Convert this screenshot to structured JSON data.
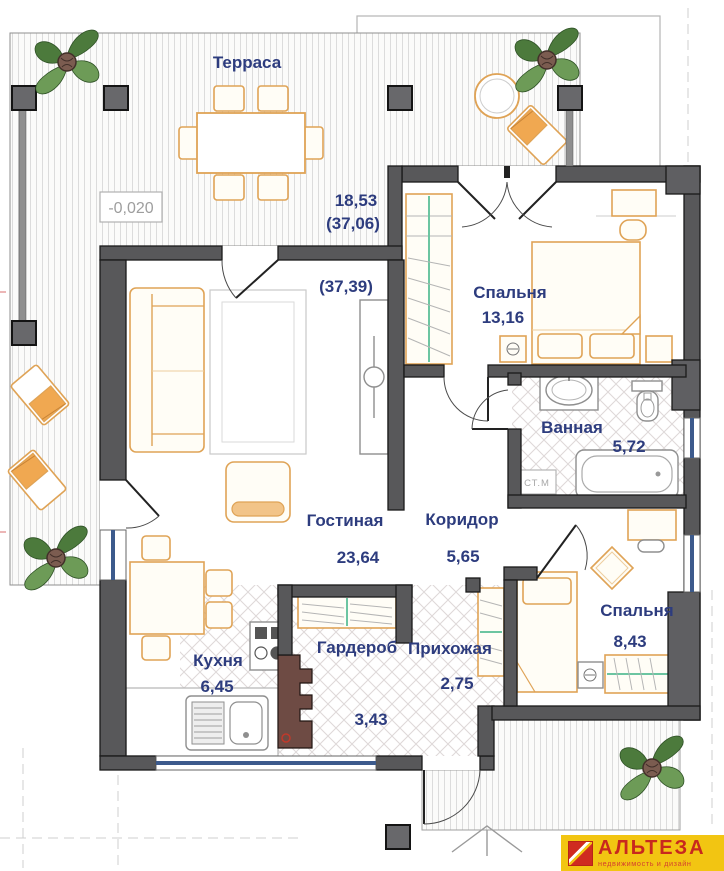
{
  "plan": {
    "terrace": {
      "name": "Терраса",
      "elevation": "-0,020",
      "area": "18,53",
      "area_total": "(37,06)",
      "area_total2": "(37,39)"
    },
    "rooms": {
      "bedroom_main": {
        "name": "Спальня",
        "area": "13,16"
      },
      "bathroom": {
        "name": "Ванная",
        "area": "5,72"
      },
      "living": {
        "name": "Гостиная",
        "area": "23,64"
      },
      "corridor": {
        "name": "Коридор",
        "area": "5,65"
      },
      "bedroom_small": {
        "name": "Спальня",
        "area": "8,43"
      },
      "kitchen": {
        "name": "Кухня",
        "area": "6,45"
      },
      "wardrobe": {
        "name": "Гардероб"
      },
      "entry_hall": {
        "name": "Прихожая",
        "area": "2,75"
      },
      "vestibule": {
        "area": "3,43"
      }
    },
    "appliances": {
      "washing_machine": "СТ.М"
    }
  },
  "logo": {
    "brand": "АЛЬТЕЗА",
    "tagline": "недвижимость и дизайн"
  },
  "colors": {
    "wall": "#58585a",
    "furniture_accent": "#dfa356",
    "room_label": "#2d3c7e",
    "window": "#3c5a8c",
    "hanger_green": "#6cc5a1",
    "logo_bg": "#f2c512",
    "logo_text": "#c8281e"
  }
}
